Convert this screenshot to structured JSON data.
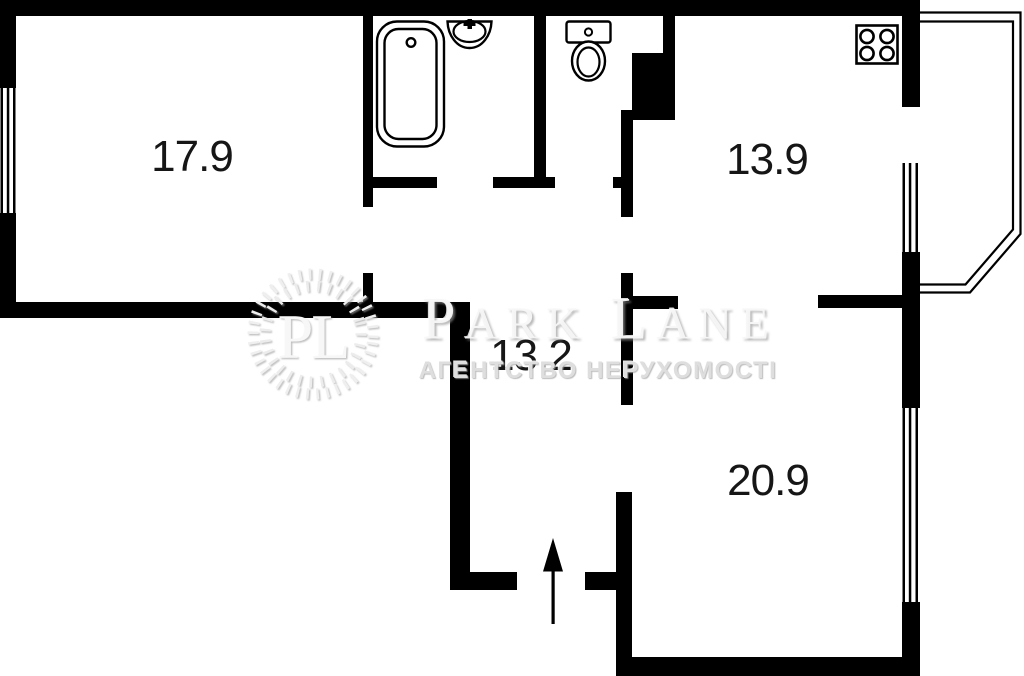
{
  "page": {
    "background_color": "#ffffff"
  },
  "floor_plan": {
    "wall_color": "#000000",
    "room_area_labels": {
      "top_left_room": "17.9",
      "kitchen": "13.9",
      "hallway": "13.2",
      "bottom_right_room": "20.9"
    },
    "fixtures": [
      "bathtub-icon",
      "sink-icon",
      "toilet-icon",
      "stove-icon",
      "entrance-arrow-icon"
    ],
    "windows_count": 3,
    "has_balcony": true
  },
  "watermark": {
    "color": "#e3e3e3",
    "monogram": "PL",
    "brand_word1": "PARK",
    "brand_word2": "LANE",
    "tagline": "АГЕНТСТВО НЕРУХОМОСТІ"
  }
}
